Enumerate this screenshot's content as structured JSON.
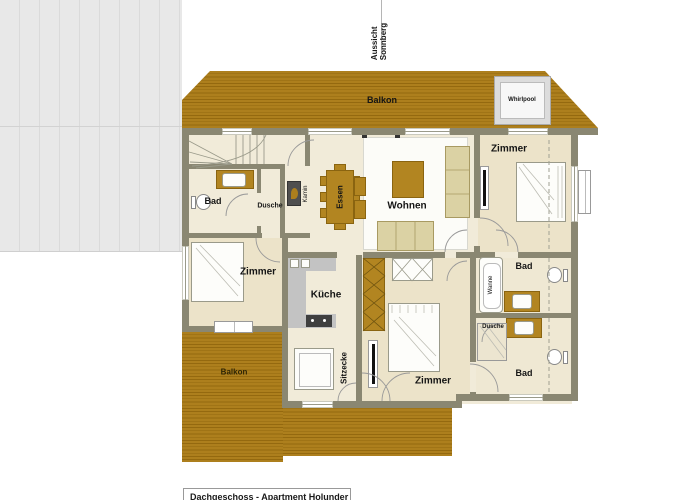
{
  "plan": {
    "labels": {
      "balkon_top": "Balkon",
      "whirlpool": "Whirlpool",
      "zimmer_top_right": "Zimmer",
      "bad_left": "Bad",
      "dusche_left": "Dusche",
      "kamin": "Kamin",
      "essen": "Essen",
      "wohnen": "Wohnen",
      "zimmer_left": "Zimmer",
      "kueche": "Küche",
      "sitzecke": "Sitzecke",
      "zimmer_bottom": "Zimmer",
      "bad_mid_right": "Bad",
      "wanne": "Wanne",
      "dusche_right": "Dusche",
      "bad_bottom_right": "Bad",
      "balkon_bottom": "Balkon"
    },
    "orientation": {
      "line1": "Aussicht",
      "line2": "Sonnberg"
    },
    "caption": "Dachgeschoss - Apartment Holunder"
  },
  "colors": {
    "balcony": "#ad7f1d",
    "wall": "#8a8772",
    "floor": "#f1ebd9",
    "furniture_tan": "#dbd2a4",
    "furniture_gold": "#b28521",
    "counter_gray": "#c3c3c3",
    "area_gray": "#e8e8e8"
  }
}
